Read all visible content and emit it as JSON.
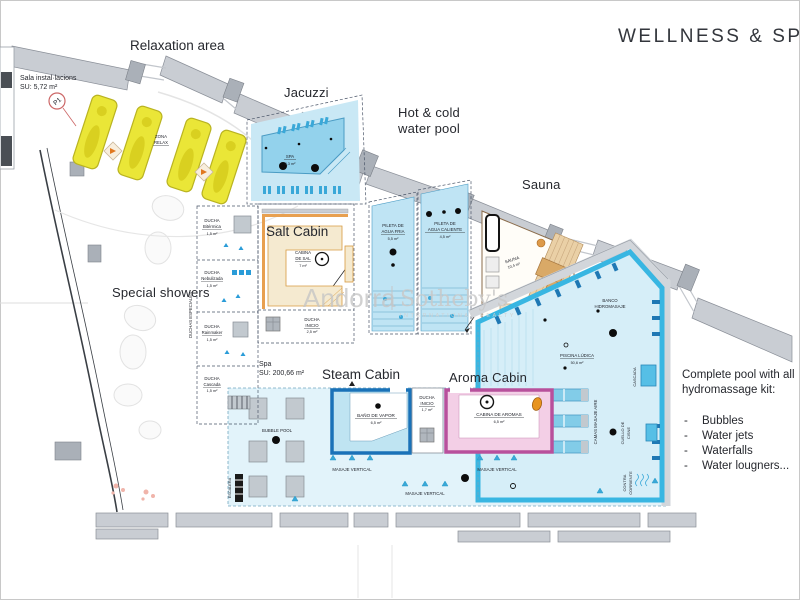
{
  "title": "WELLNESS  &  SPA",
  "watermark": {
    "brand_left": "Andorra",
    "brand_right": "Sotheby's",
    "subtitle": "INTERNATIONAL REALTY"
  },
  "headings": {
    "relaxation": "Relaxation area",
    "jacuzzi": "Jacuzzi",
    "hot_cold_line1": "Hot & cold",
    "hot_cold_line2": "water pool",
    "sauna": "Sauna",
    "salt_cabin": "Salt Cabin",
    "special_showers": "Special showers",
    "steam_cabin": "Steam Cabin",
    "aroma_cabin": "Aroma Cabin"
  },
  "notes": {
    "sala": {
      "line1": "Sala instal·lacions",
      "line2": "SU: 5,72 m²"
    },
    "spa_area": {
      "line1": "Spa",
      "line2": "SU: 200,66 m²"
    },
    "pool_kit": {
      "line1": "Complete pool with all",
      "line2": "hydromassage kit:",
      "bullet": "-",
      "items": [
        "Bubbles",
        "Water jets",
        "Waterfalls",
        "Water lougners..."
      ]
    }
  },
  "rooms": {
    "zona_relax_line1": "ZONA",
    "zona_relax_line2": "RELAX",
    "p1": "P1",
    "spa_pool": {
      "name": "SPA",
      "area": "8,3 m²"
    },
    "pileta_fria": {
      "line1": "PILETA DE",
      "line2": "AGUA FRIA",
      "area": "5,5 m²"
    },
    "pileta_caliente": {
      "line1": "PILETA DE",
      "line2": "AGUA CALIENTE",
      "area": "4,5 m²"
    },
    "sauna": {
      "name": "SAUNA",
      "area": "10,4 m²"
    },
    "banco": {
      "line1": "BANCO",
      "line2": "HIDROMASAJE"
    },
    "piscina": {
      "name": "PISCINA LÚDICA",
      "area": "50,6 m²"
    },
    "cascada": "CASCADA",
    "camas": "CAMAS MASAJE AIRE",
    "cuello": {
      "line1": "CUELLO DE",
      "line2": "CISNE"
    },
    "contra": {
      "line1": "CONTRA",
      "line2": "CORRIENTE"
    },
    "duchas_especiales": "DUCHAS ESPECIALES",
    "showers": [
      {
        "label": "DUCHA",
        "name": "Bitérmica",
        "area": "1,5 m²"
      },
      {
        "label": "DUCHA",
        "name": "Nebulizada",
        "area": "1,5 m²"
      },
      {
        "label": "DUCHA",
        "name": "Rainmaker",
        "area": "1,5 m²"
      },
      {
        "label": "DUCHA",
        "name": "Cascada",
        "area": "1,5 m²"
      }
    ],
    "cabina_sal": {
      "line1": "CABINA",
      "line2": "DE SAL",
      "area": "7 m²"
    },
    "ducha_inicio_salt": {
      "line1": "DUCHA",
      "line2": "INICIO",
      "area": "2,5 m²"
    },
    "bano_vapor": {
      "name": "BAÑO DE VAPOR",
      "area": "6,5 m²"
    },
    "ducha_inicio_mid": {
      "line1": "DUCHA",
      "line2": "INICIO",
      "area": "1,7 m²"
    },
    "cabina_aromas": {
      "name": "CABINA DE AROMAS",
      "area": "6,5 m²"
    },
    "bubble_pool": "BUBBLE POOL",
    "escalera": "ESCALERA",
    "masaje_vertical": "MASAJE VERTICAL"
  },
  "colors": {
    "pool_light": "#c9e8f5",
    "pool_inner": "#93d2ec",
    "pool_border": "#38b6e2",
    "seat_blue": "#1f78b4",
    "floor_zone": "#e2f3fa",
    "piscina_fill": "#d6eef8",
    "lane_blue": "#82cce8",
    "steam_blue": "#1a72b8",
    "aroma_magenta": "#b8509c",
    "aroma_fill": "#f3cfe6",
    "salt_cream": "#f5ead0",
    "salt_orange": "#e8a050",
    "wood": "#d9a967",
    "lounger_yellow": "#eae637",
    "wall_gray": "#c9cdd3"
  }
}
